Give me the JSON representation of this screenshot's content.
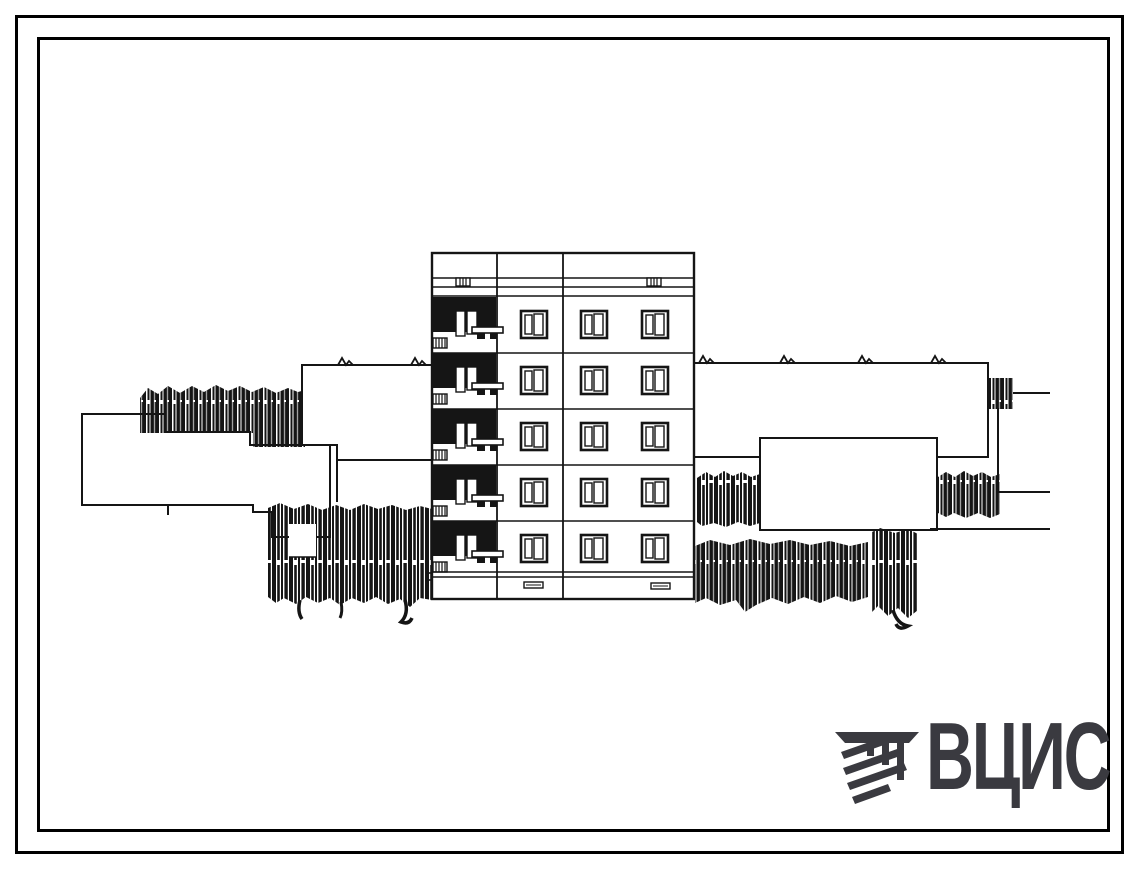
{
  "page": {
    "background": "#ffffff",
    "ink_color": "#151515",
    "frame_color": "#000000",
    "content_type": "architectural elevation drawing of 5-storey block section with neighbouring buildings and trees"
  },
  "building": {
    "floors": 5,
    "floor_tops": [
      297,
      353,
      409,
      465,
      521
    ]
  },
  "logo": {
    "text": "ВЦИС",
    "color": "#3a3a40",
    "icon": "hatched-beam-logo-icon"
  },
  "icons": {
    "logo_mark": "diagonal-hatched-beam",
    "tree_texture": "vertical-hatch-strokes"
  }
}
